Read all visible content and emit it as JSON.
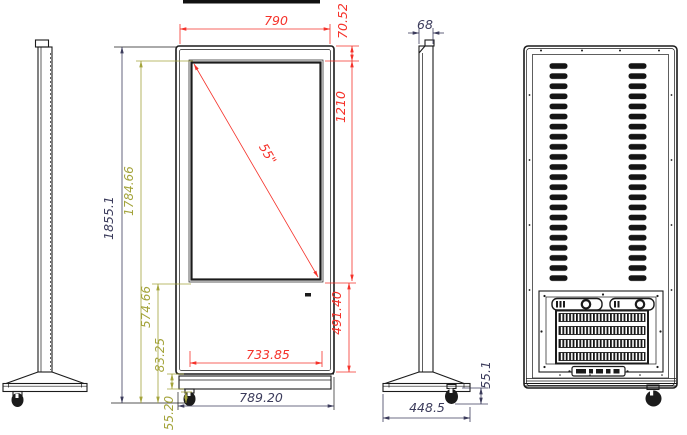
{
  "colors": {
    "dimension_red": "#f5322a",
    "dimension_olive": "#a4a43c",
    "dimension_navy": "#3c3c5c",
    "drawing_line": "#1b1b1b",
    "background": "#ffffff"
  },
  "dimensions": {
    "front": {
      "top_width": "790",
      "top_bezel_height": "70.52",
      "screen_height": "1210",
      "screen_diagonal": "55\"",
      "lower_panel_height": "491.40",
      "screen_width": "733.85",
      "overall_height": "1855.1",
      "screen_top_to_ground": "1784.66",
      "screen_bottom_to_ground": "574.66",
      "plinth_height": "83.25",
      "caster_height": "55.20",
      "bottom_width": "789.20"
    },
    "side": {
      "body_thickness": "68",
      "base_depth": "448.5",
      "base_height": "55.1"
    }
  }
}
